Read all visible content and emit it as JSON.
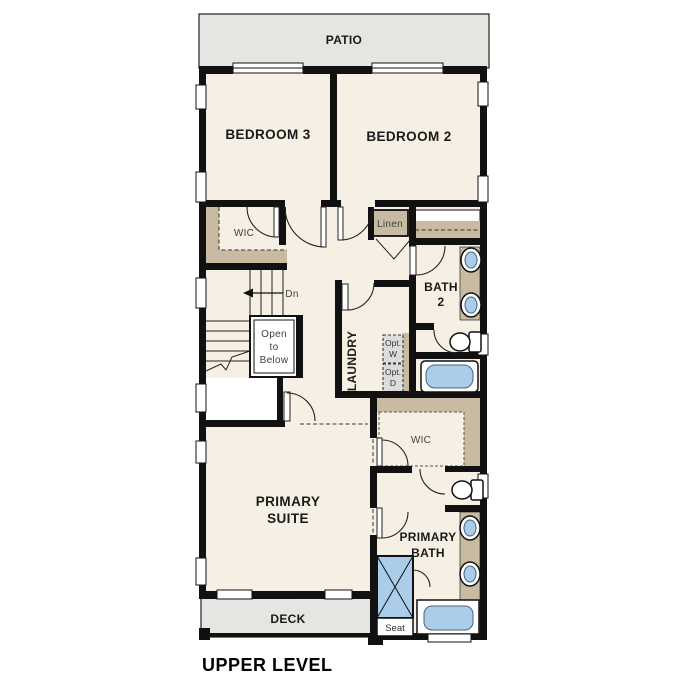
{
  "title": "UPPER LEVEL",
  "colors": {
    "wall": "#111111",
    "floor": "#f6f0e4",
    "outdoor_concrete": "#e5e5e2",
    "cabinet_tan": "#c9bba1",
    "fixture_blue": "#abcde9",
    "optional_gray": "#dcdcdc",
    "label_dark": "#1a1a1a",
    "label_soft": "#3f3f3f"
  },
  "labels": {
    "patio": "PATIO",
    "bedroom3": "BEDROOM 3",
    "bedroom2": "BEDROOM 2",
    "wic_top": "WIC",
    "linen": "Linen",
    "bath2": [
      "BATH",
      "2"
    ],
    "laundry": "LAUNDRY",
    "opt_w": [
      "Opt.",
      "W"
    ],
    "opt_d": [
      "Opt.",
      "D"
    ],
    "stairs_dn": "Dn",
    "open_to_below": [
      "Open",
      "to",
      "Below"
    ],
    "primary_suite": [
      "PRIMARY",
      "SUITE"
    ],
    "wic_primary": "WIC",
    "primary_bath": [
      "PRIMARY",
      "BATH"
    ],
    "seat": "Seat",
    "deck": "DECK"
  }
}
